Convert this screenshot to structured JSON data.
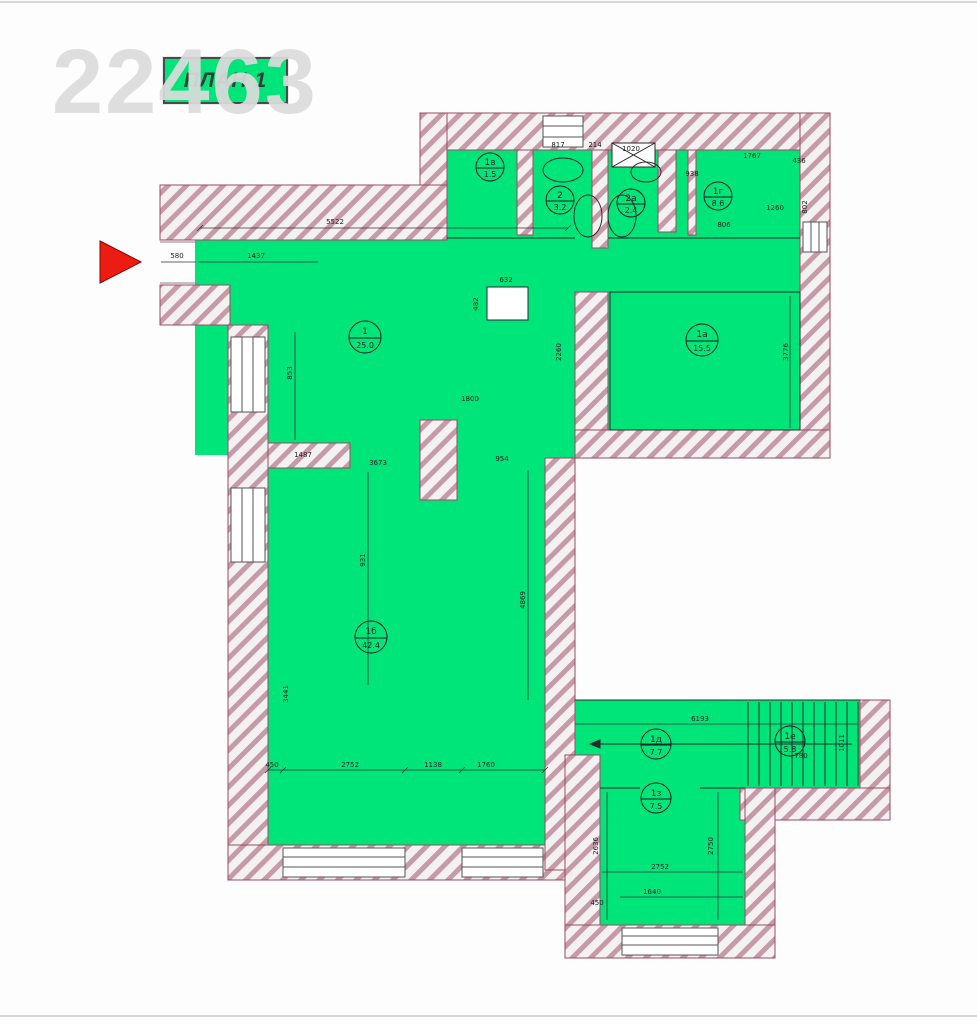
{
  "watermark": "22463",
  "title": {
    "label": "ПЛАН 1"
  },
  "colors": {
    "room_fill": "#00e57a",
    "wall_hatch_line": "#c79aa8",
    "wall_outline": "#9b4a63",
    "entry_arrow": "#ec1c13",
    "watermark_gray": "#dcdcdc",
    "drawing_line": "#1d1d1d"
  },
  "entry_arrow": {
    "direction": "right"
  },
  "plan": {
    "rooms": [
      {
        "num": "1",
        "area": "25.0"
      },
      {
        "num": "1а",
        "area": "15.5"
      },
      {
        "num": "1б",
        "area": "42.4"
      },
      {
        "num": "1в",
        "area": "1.5"
      },
      {
        "num": "1г",
        "area": "8.6"
      },
      {
        "num": "2",
        "area": "3.2"
      },
      {
        "num": "2а",
        "area": "2.4"
      },
      {
        "num": "1д",
        "area": "7.7"
      },
      {
        "num": "1е",
        "area": "5.8"
      },
      {
        "num": "1з",
        "area": "7.5"
      }
    ],
    "dims": [
      {
        "t": "5522"
      },
      {
        "t": "1437"
      },
      {
        "t": "580"
      },
      {
        "t": "632"
      },
      {
        "t": "482"
      },
      {
        "t": "817"
      },
      {
        "t": "214"
      },
      {
        "t": "1020"
      },
      {
        "t": "1767"
      },
      {
        "t": "436"
      },
      {
        "t": "938"
      },
      {
        "t": "802"
      },
      {
        "t": "1260"
      },
      {
        "t": "806"
      },
      {
        "t": "3776"
      },
      {
        "t": "2260"
      },
      {
        "t": "853"
      },
      {
        "t": "931"
      },
      {
        "t": "1487"
      },
      {
        "t": "3673"
      },
      {
        "t": "954"
      },
      {
        "t": "1800"
      },
      {
        "t": "3441"
      },
      {
        "t": "4869"
      },
      {
        "t": "450"
      },
      {
        "t": "2752"
      },
      {
        "t": "1138"
      },
      {
        "t": "1760"
      },
      {
        "t": "6193"
      },
      {
        "t": "780"
      },
      {
        "t": "1011"
      },
      {
        "t": "2636"
      },
      {
        "t": "2750"
      },
      {
        "t": "2752"
      },
      {
        "t": "1640"
      },
      {
        "t": "450"
      }
    ]
  }
}
